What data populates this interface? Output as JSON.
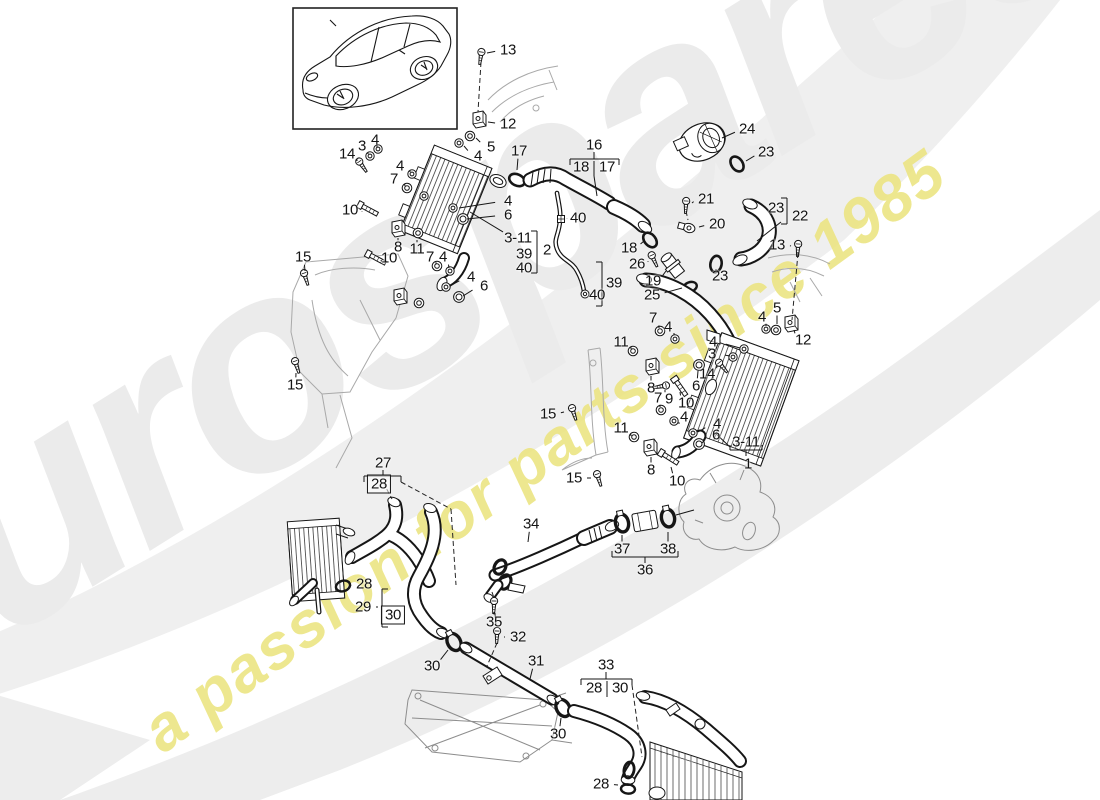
{
  "watermark": {
    "brand": "eurospares",
    "tagline": "a passion for parts since 1985",
    "brand_color": "#ebebeb",
    "tagline_color": "#ece583"
  },
  "diagram": {
    "vehicle": "Porsche Panamera",
    "subject": "charge air cooler, pressure pipes and hoses exploded parts diagram"
  },
  "callouts": [
    {
      "t": "13",
      "x": 508,
      "y": 50,
      "lx": 487,
      "ly": 53
    },
    {
      "t": "12",
      "x": 508,
      "y": 124,
      "lx": 488,
      "ly": 122
    },
    {
      "t": "5",
      "x": 491,
      "y": 147,
      "lx": 476,
      "ly": 138
    },
    {
      "t": "4",
      "x": 478,
      "y": 156,
      "lx": 464,
      "ly": 146
    },
    {
      "t": "17",
      "x": 519,
      "y": 151,
      "lx": 517,
      "ly": 170
    },
    {
      "t": "16",
      "x": 594,
      "y": 145
    },
    {
      "t": "18",
      "x": 581,
      "y": 167
    },
    {
      "t": "17",
      "x": 607,
      "y": 167
    },
    {
      "t": "14",
      "x": 347,
      "y": 154,
      "lx": 357,
      "ly": 161
    },
    {
      "t": "3",
      "x": 362,
      "y": 146,
      "lx": 368,
      "ly": 154
    },
    {
      "t": "4",
      "x": 375,
      "y": 140,
      "lx": 377,
      "ly": 147
    },
    {
      "t": "4",
      "x": 400,
      "y": 166,
      "lx": 410,
      "ly": 172
    },
    {
      "t": "7",
      "x": 394,
      "y": 179,
      "lx": 405,
      "ly": 186
    },
    {
      "t": "10",
      "x": 350,
      "y": 210,
      "lx": 362,
      "ly": 212
    },
    {
      "t": "8",
      "x": 398,
      "y": 247,
      "lx": 398,
      "ly": 238
    },
    {
      "t": "11",
      "x": 417,
      "y": 249,
      "lx": 417,
      "ly": 240
    },
    {
      "t": "7",
      "x": 430,
      "y": 257,
      "lx": 436,
      "ly": 264
    },
    {
      "t": "4",
      "x": 443,
      "y": 257,
      "lx": 449,
      "ly": 268
    },
    {
      "t": "10",
      "x": 389,
      "y": 258,
      "lx": 381,
      "ly": 261
    },
    {
      "t": "4",
      "x": 508,
      "y": 201,
      "lx": 459,
      "ly": 208
    },
    {
      "t": "6",
      "x": 508,
      "y": 215,
      "lx": 467,
      "ly": 219
    },
    {
      "t": "4",
      "x": 471,
      "y": 277,
      "lx": 450,
      "ly": 286
    },
    {
      "t": "6",
      "x": 484,
      "y": 286,
      "lx": 463,
      "ly": 296
    },
    {
      "t": "3-11",
      "x": 518,
      "y": 238,
      "lx": 470,
      "ly": 212
    },
    {
      "t": "39",
      "x": 524,
      "y": 254
    },
    {
      "t": "40",
      "x": 524,
      "y": 268
    },
    {
      "t": "2",
      "x": 547,
      "y": 250,
      "lx": 539,
      "ly": 250
    },
    {
      "t": "40",
      "x": 578,
      "y": 218,
      "lx": 567,
      "ly": 219
    },
    {
      "t": "39",
      "x": 614,
      "y": 283,
      "lx": 605,
      "ly": 283
    },
    {
      "t": "40",
      "x": 597,
      "y": 295,
      "lx": 590,
      "ly": 294
    },
    {
      "t": "18",
      "x": 629,
      "y": 248,
      "lx": 644,
      "ly": 241
    },
    {
      "t": "26",
      "x": 637,
      "y": 264,
      "lx": 648,
      "ly": 261
    },
    {
      "t": "19",
      "x": 653,
      "y": 281,
      "lx": 666,
      "ly": 271
    },
    {
      "t": "25",
      "x": 652,
      "y": 295,
      "lx": 682,
      "ly": 288
    },
    {
      "t": "21",
      "x": 706,
      "y": 199,
      "lx": 692,
      "ly": 203
    },
    {
      "t": "20",
      "x": 717,
      "y": 224,
      "lx": 699,
      "ly": 227
    },
    {
      "t": "23",
      "x": 720,
      "y": 276,
      "lx": 716,
      "ly": 269
    },
    {
      "t": "24",
      "x": 747,
      "y": 129,
      "lx": 722,
      "ly": 138
    },
    {
      "t": "23",
      "x": 766,
      "y": 152,
      "lx": 746,
      "ly": 161
    },
    {
      "t": "23",
      "x": 776,
      "y": 208
    },
    {
      "t": "22",
      "x": 800,
      "y": 216,
      "lx": 791,
      "ly": 216
    },
    {
      "t": "13",
      "x": 777,
      "y": 245,
      "lx": 791,
      "ly": 246
    },
    {
      "t": "15",
      "x": 303,
      "y": 257,
      "lx": 305,
      "ly": 271
    },
    {
      "t": "15",
      "x": 295,
      "y": 385,
      "lx": 296,
      "ly": 373
    },
    {
      "t": "5",
      "x": 777,
      "y": 308,
      "lx": 777,
      "ly": 324
    },
    {
      "t": "4",
      "x": 762,
      "y": 317,
      "lx": 766,
      "ly": 326
    },
    {
      "t": "12",
      "x": 803,
      "y": 340,
      "lx": 794,
      "ly": 330
    },
    {
      "t": "7",
      "x": 653,
      "y": 318,
      "lx": 659,
      "ly": 328
    },
    {
      "t": "4",
      "x": 668,
      "y": 327,
      "lx": 674,
      "ly": 335
    },
    {
      "t": "11",
      "x": 621,
      "y": 342,
      "lx": 631,
      "ly": 349
    },
    {
      "t": "8",
      "x": 651,
      "y": 388,
      "lx": 651,
      "ly": 376
    },
    {
      "t": "4",
      "x": 713,
      "y": 342,
      "lx": 740,
      "ly": 348
    },
    {
      "t": "3",
      "x": 712,
      "y": 354,
      "lx": 730,
      "ly": 356
    },
    {
      "t": "14",
      "x": 707,
      "y": 374,
      "lx": 717,
      "ly": 366
    },
    {
      "t": "6",
      "x": 696,
      "y": 386,
      "lx": 698,
      "ly": 371
    },
    {
      "t": "9",
      "x": 669,
      "y": 399,
      "lx": 665,
      "ly": 390
    },
    {
      "t": "10",
      "x": 686,
      "y": 403,
      "lx": 680,
      "ly": 392
    },
    {
      "t": "7",
      "x": 658,
      "y": 398,
      "lx": 660,
      "ly": 407
    },
    {
      "t": "4",
      "x": 684,
      "y": 417,
      "lx": 679,
      "ly": 424
    },
    {
      "t": "11",
      "x": 621,
      "y": 428,
      "lx": 631,
      "ly": 436
    },
    {
      "t": "4",
      "x": 717,
      "y": 424,
      "lx": 698,
      "ly": 432
    },
    {
      "t": "6",
      "x": 716,
      "y": 435,
      "lx": 702,
      "ly": 443
    },
    {
      "t": "8",
      "x": 651,
      "y": 470,
      "lx": 651,
      "ly": 457
    },
    {
      "t": "10",
      "x": 677,
      "y": 481,
      "lx": 671,
      "ly": 467
    },
    {
      "t": "3-11",
      "x": 746,
      "y": 442
    },
    {
      "t": "1",
      "x": 748,
      "y": 464
    },
    {
      "t": "15",
      "x": 548,
      "y": 414,
      "lx": 564,
      "ly": 412
    },
    {
      "t": "15",
      "x": 574,
      "y": 478,
      "lx": 591,
      "ly": 478
    },
    {
      "t": "27",
      "x": 383,
      "y": 463
    },
    {
      "t": "28",
      "x": 379,
      "y": 484,
      "boxed": true
    },
    {
      "t": "28",
      "x": 364,
      "y": 584,
      "lx": 350,
      "ly": 586
    },
    {
      "t": "29",
      "x": 363,
      "y": 607,
      "lx": 378,
      "ly": 607
    },
    {
      "t": "30",
      "x": 393,
      "y": 615,
      "boxed": true
    },
    {
      "t": "34",
      "x": 531,
      "y": 524,
      "lx": 528,
      "ly": 542
    },
    {
      "t": "35",
      "x": 494,
      "y": 622,
      "lx": 494,
      "ly": 612
    },
    {
      "t": "32",
      "x": 518,
      "y": 637,
      "lx": 504,
      "ly": 637
    },
    {
      "t": "30",
      "x": 432,
      "y": 666,
      "lx": 448,
      "ly": 650
    },
    {
      "t": "31",
      "x": 536,
      "y": 661,
      "lx": 530,
      "ly": 679
    },
    {
      "t": "33",
      "x": 606,
      "y": 665
    },
    {
      "t": "28",
      "x": 594,
      "y": 688
    },
    {
      "t": "30",
      "x": 620,
      "y": 688
    },
    {
      "t": "30",
      "x": 558,
      "y": 734,
      "lx": 561,
      "ly": 718
    },
    {
      "t": "28",
      "x": 601,
      "y": 784,
      "lx": 618,
      "ly": 785
    },
    {
      "t": "37",
      "x": 622,
      "y": 549,
      "lx": 622,
      "ly": 535
    },
    {
      "t": "38",
      "x": 668,
      "y": 549,
      "lx": 668,
      "ly": 532
    },
    {
      "t": "36",
      "x": 645,
      "y": 570
    }
  ]
}
